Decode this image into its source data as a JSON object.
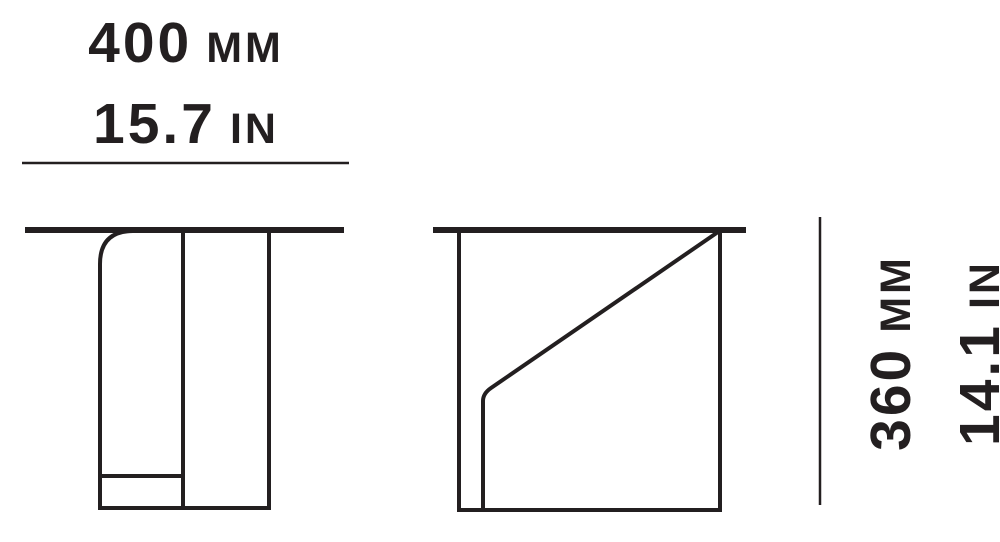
{
  "page": {
    "background_color": "#ffffff",
    "line_color": "#231f20"
  },
  "width_dimension": {
    "mm_value": "400",
    "mm_unit": "MM",
    "in_value": "15.7",
    "in_unit": "IN"
  },
  "height_dimension": {
    "mm_value": "360",
    "mm_unit": "MM",
    "in_value": "14.1",
    "in_unit": "IN"
  }
}
